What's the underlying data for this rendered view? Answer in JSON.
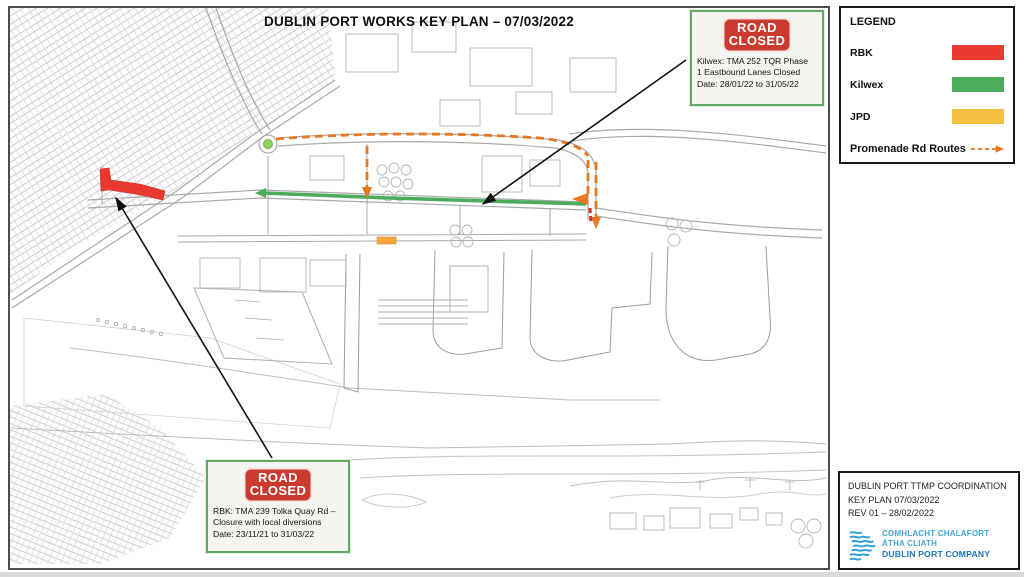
{
  "title": "DUBLIN PORT WORKS KEY PLAN – 07/03/2022",
  "legend": {
    "title": "LEGEND",
    "items": [
      {
        "label": "RBK",
        "color": "#ea3b30"
      },
      {
        "label": "Kilwex",
        "color": "#4cab5c"
      },
      {
        "label": "JPD",
        "color": "#f4c043"
      }
    ],
    "route": {
      "label": "Promenade Rd Routes",
      "color": "#e87722"
    }
  },
  "callouts": [
    {
      "sign": [
        "ROAD",
        "CLOSED"
      ],
      "sign_color": "#cb3a2e",
      "lines": [
        "Kilwex: TMA 252 TQR Phase",
        "1 Eastbound Lanes Closed",
        "Date: 28/01/22 to 31/05/22"
      ]
    },
    {
      "sign": [
        "ROAD",
        "CLOSED"
      ],
      "sign_color": "#cb3a2e",
      "lines": [
        "RBK: TMA 239 Tolka Quay Rd –",
        "Closure with local diversions",
        "Date: 23/11/21 to 31/03/22"
      ]
    }
  ],
  "title_block": {
    "lines": [
      "DUBLIN PORT TTMP COORDINATION",
      "KEY PLAN  07/03/2022",
      "REV 01 – 28/02/2022"
    ],
    "logo": {
      "line1": "COMHLACHT CHALAFORT",
      "line2": "ÁTHA CLIATH",
      "line3": "DUBLIN PORT COMPANY"
    }
  },
  "map": {
    "overlays": [
      {
        "name": "rbk-tolka-quay-closure",
        "color": "#e8392e"
      },
      {
        "name": "kilwex-tqr-eastbound-route",
        "color": "#4cab5c"
      },
      {
        "name": "jpd-works-segment",
        "color": "#f3a73d"
      },
      {
        "name": "promenade-rd-route-dashed",
        "color": "#e87722"
      },
      {
        "name": "rbk-east-closure-mark",
        "color": "#e03025"
      }
    ]
  }
}
